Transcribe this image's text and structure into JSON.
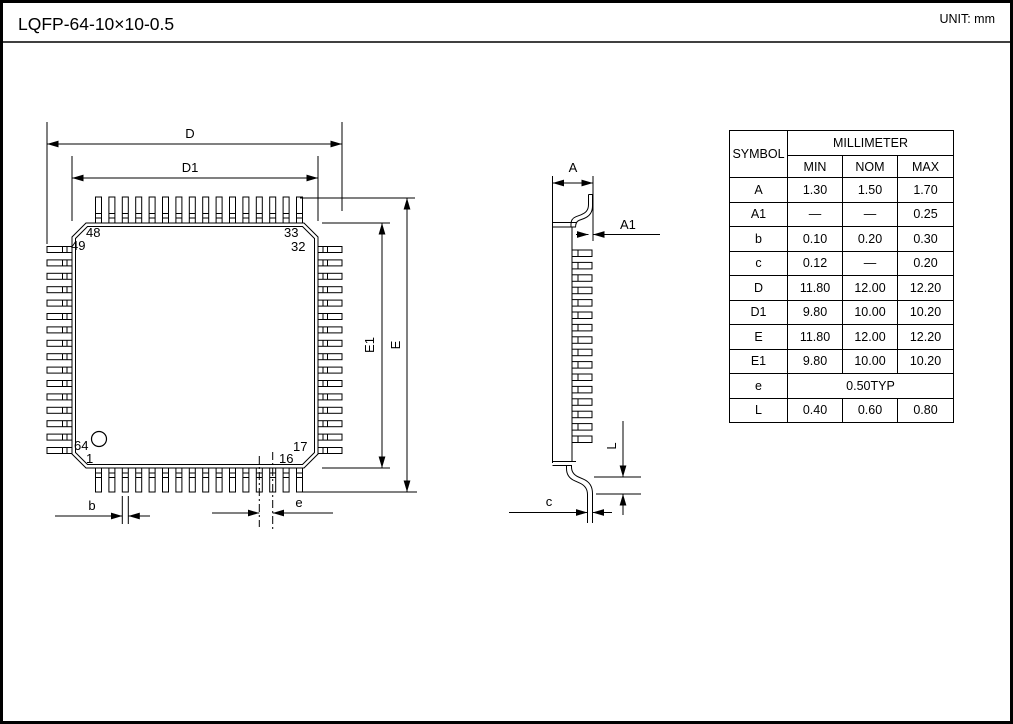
{
  "title": "LQFP-64-10×10-0.5",
  "unit_label": "UNIT: mm",
  "colors": {
    "line": "#000000",
    "background": "#ffffff"
  },
  "top_view": {
    "dim_labels": {
      "D": "D",
      "D1": "D1",
      "E": "E",
      "E1": "E1",
      "b": "b",
      "e": "e"
    },
    "pin_numbers": {
      "n48": "48",
      "n33": "33",
      "n49": "49",
      "n32": "32",
      "n64": "64",
      "n1": "1",
      "n17": "17",
      "n16": "16"
    }
  },
  "side_view": {
    "dim_labels": {
      "A": "A",
      "A1": "A1",
      "L": "L",
      "c": "c"
    }
  },
  "table": {
    "header": {
      "symbol": "SYMBOL",
      "group": "MILLIMETER",
      "min": "MIN",
      "nom": "NOM",
      "max": "MAX"
    },
    "rows": [
      {
        "symbol": "A",
        "min": "1.30",
        "nom": "1.50",
        "max": "1.70"
      },
      {
        "symbol": "A1",
        "min": "—",
        "nom": "—",
        "max": "0.25"
      },
      {
        "symbol": "b",
        "min": "0.10",
        "nom": "0.20",
        "max": "0.30"
      },
      {
        "symbol": "c",
        "min": "0.12",
        "nom": "—",
        "max": "0.20"
      },
      {
        "symbol": "D",
        "min": "11.80",
        "nom": "12.00",
        "max": "12.20"
      },
      {
        "symbol": "D1",
        "min": "9.80",
        "nom": "10.00",
        "max": "10.20"
      },
      {
        "symbol": "E",
        "min": "11.80",
        "nom": "12.00",
        "max": "12.20"
      },
      {
        "symbol": "E1",
        "min": "9.80",
        "nom": "10.00",
        "max": "10.20"
      },
      {
        "symbol": "e",
        "span": "0.50TYP"
      },
      {
        "symbol": "L",
        "min": "0.40",
        "nom": "0.60",
        "max": "0.80"
      }
    ]
  }
}
